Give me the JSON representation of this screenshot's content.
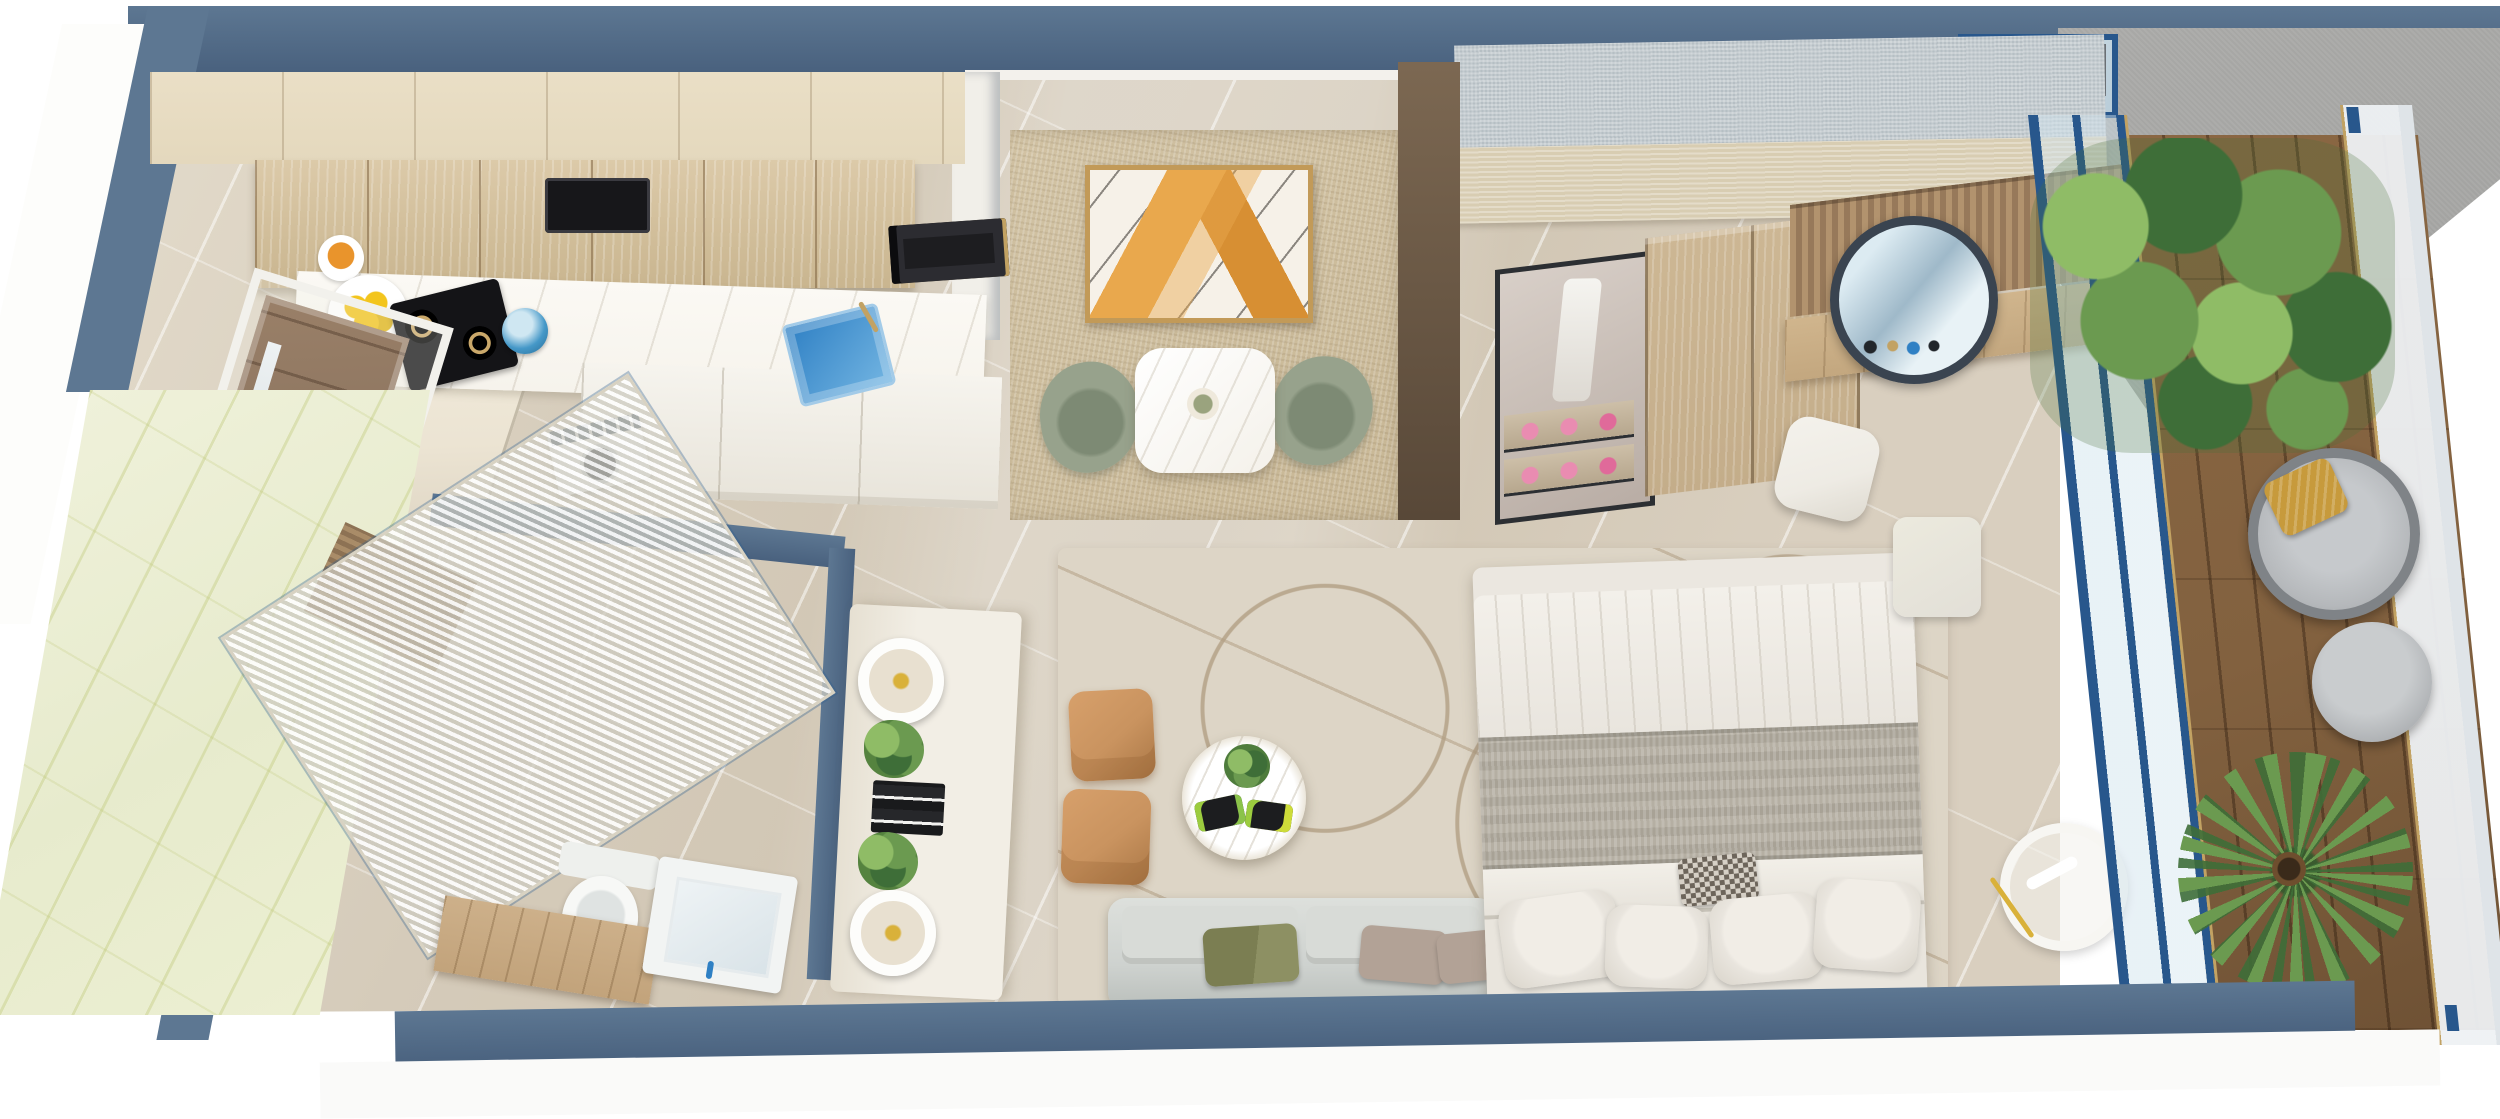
{
  "meta": {
    "title": "3D isometric floor plan render of a studio apartment",
    "image_width": 2500,
    "image_height": 1100,
    "style": "photorealistic architectural visualization, top-down oblique view, no visible text"
  },
  "colors": {
    "wall": "#5d7792",
    "wallDark": "#49617e",
    "floor": "#d7cdbd",
    "rugCream": "#ddd5c6",
    "woodCabinet": "#d6c3a0",
    "woodTopBand": "#e4d8bd",
    "doorWood": "#8d7560",
    "fridgeCream": "#ece4d3",
    "counterWhite": "#f6f3ec",
    "displayBlue": "#3d4e63",
    "lemonYellow": "#f3c51d",
    "orangeFruit": "#e9942c",
    "sinkBlue": "#2f80c4",
    "kettleBlue": "#4598c8",
    "accentWallBeige": "#c8b795",
    "artOrange": "#e9a84d",
    "artAmber": "#d78f33",
    "frameGold": "#c29a58",
    "canvasWhite": "#f6f1e8",
    "chairSage": "#97a28c",
    "chairSageDark": "#7d8a74",
    "tableMarble": "#f4f1ea",
    "wardrobeGray": "#b6bfc4",
    "wardrobeBeige": "#d8cdb2",
    "wardrobeWood": "#c4ad8a",
    "displayPink": "#e98cb1",
    "slatWood": "#a98c68",
    "mirrorRim": "#3a4450",
    "deskWood": "#c3a77f",
    "stoolWhite": "#eeebe4",
    "poufCaramel": "#c9935f",
    "poufCaramelDark": "#aa7746",
    "sofaGray": "#ced2cf",
    "sofaGrayDark": "#b9beba",
    "pillowOlive": "#7b7e52",
    "pillowTaupe": "#b2a296",
    "bedWhite": "#ebe7e0",
    "throwGray": "#a8a296",
    "pillowWhite": "#e9e5de",
    "cushionCheck": "#6d655b",
    "benchWhite": "#e2dfd7",
    "marbleGreen": "#e7ebcd",
    "toiletWhite": "#f7f8f6",
    "vanityWood": "#c2a37b",
    "basinWhite": "#f2f4f3",
    "consoleWhite": "#f2eee5",
    "lampWhite": "#fdfdfb",
    "lampYellow": "#d9b13a",
    "plantGreen": "#6b9a50",
    "plantDark": "#3e6e38",
    "plantLight": "#8fbc66",
    "deckWood": "#82613f",
    "rattanGray": "#7f8387",
    "cushionGray": "#b5b8bb",
    "mustard": "#c79a3c",
    "goldTrim": "#c2a263",
    "blueFrame": "#28578c",
    "glassTint": "#dfe9ef",
    "exteriorGray": "#a0a09e"
  },
  "scene": {
    "type": "3d-floor-plan-render",
    "unit": "studio apartment with balcony",
    "rooms": [
      {
        "id": "entry-kitchen",
        "position": "top-left",
        "items": [
          "entry-door",
          "door-frame",
          "refrigerator",
          "upper-cabinets-top-face",
          "upper-cabinet-fronts",
          "cooker-hood",
          "built-in-microwave",
          "kitchen-counter",
          "fruit-bowl",
          "lemon-bowl",
          "snack-packs",
          "gas-hob-two-burners",
          "kettle",
          "blue-glass-sink",
          "gold-faucet",
          "washing-machine-front-load",
          "white-base-cabinets"
        ]
      },
      {
        "id": "dining-nook",
        "position": "top-center",
        "items": [
          "beige-textured-accent-wall",
          "abstract-orange-artwork-gold-frame",
          "white-marble-dining-table",
          "two-place-settings",
          "centerpiece",
          "two-sage-green-chairs"
        ]
      },
      {
        "id": "bathroom",
        "position": "bottom-left",
        "items": [
          "green-onyx-marble-wall",
          "fluted-glass-shower-screen",
          "wood-slat-panel",
          "toilet",
          "wood-vanity-counter",
          "white-wash-basin",
          "blue-tap"
        ]
      },
      {
        "id": "living-area",
        "position": "center",
        "items": [
          "cream-area-rug-abstract-lines",
          "two-caramel-leather-poufs",
          "round-marble-coffee-table",
          "table-plant",
          "two-dark-serving-trays-with-fruit",
          "light-gray-sofa",
          "olive-pillow",
          "two-taupe-pillows",
          "white-media-console",
          "two-ring-table-lamps",
          "two-console-plants",
          "black-decor-stack"
        ]
      },
      {
        "id": "bedroom",
        "position": "center-right",
        "items": [
          "double-bed-white-duvet",
          "gray-woven-throw-band",
          "four-white-pillows",
          "houndstooth-accent-cushion",
          "white-bedside-pouf",
          "white-drum-floor-lamp-gold-stem"
        ]
      },
      {
        "id": "wardrobe-dressing",
        "position": "top-right",
        "items": [
          "gray-fabric-top-band",
          "beige-band",
          "glass-display-case",
          "hanging-white-garment",
          "pink-shoe-shelves",
          "wood-sliding-doors",
          "wood-slat-accent-wall",
          "round-mirror-dark-rim",
          "wood-vanity-desk",
          "cosmetics",
          "white-vanity-stool",
          "blue-frame-window"
        ]
      },
      {
        "id": "balcony",
        "position": "right",
        "items": [
          "blue-frame-glass-partition",
          "wood-plank-deck",
          "lush-planter-greenery",
          "round-rattan-lounge-chair",
          "gray-seat-cushion",
          "mustard-pillow",
          "round-gray-ottoman",
          "potted-palm",
          "glass-balustrade-gold-trim",
          "gray-textured-exterior-wall"
        ]
      }
    ],
    "structure": [
      "slate-blue-wall-band-top",
      "slate-blue-wall-band-bottom",
      "slanted-left-exterior-wall",
      "dark-wood-divider-wall",
      "white-wall-stub",
      "beige-marble-tile-floor",
      "white-exterior-apron"
    ]
  }
}
